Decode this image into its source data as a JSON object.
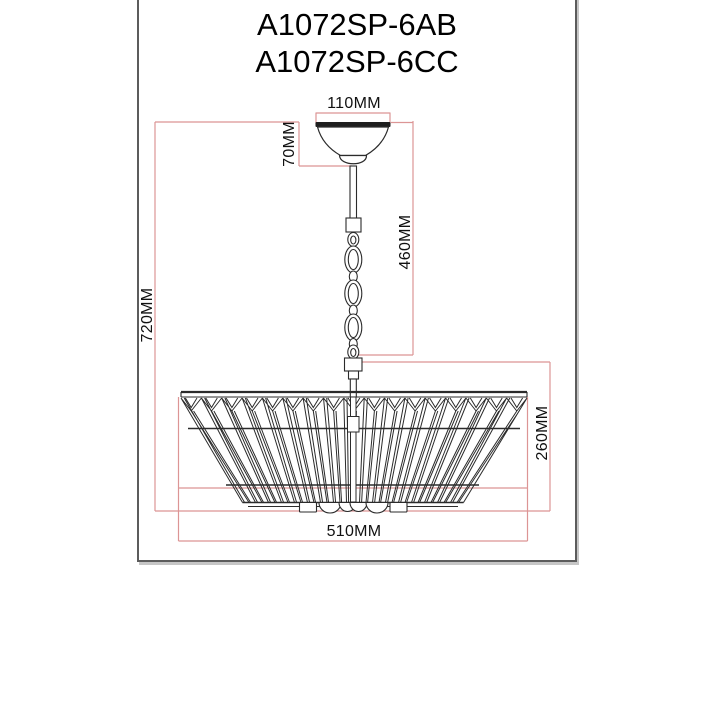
{
  "title": {
    "models": [
      "A1072SP-6AB",
      "A1072SP-6CC"
    ]
  },
  "dimensions": {
    "canopy_width": "110MM",
    "canopy_height": "70MM",
    "chain_drop": "460MM",
    "overall_height": "720MM",
    "shade_height": "260MM",
    "shade_diameter": "510MM"
  },
  "colors": {
    "dimension_line": "#dc9595",
    "drawing_line": "#2b2b2b",
    "frame_border": "#5c5c5c",
    "text": "#111111"
  }
}
